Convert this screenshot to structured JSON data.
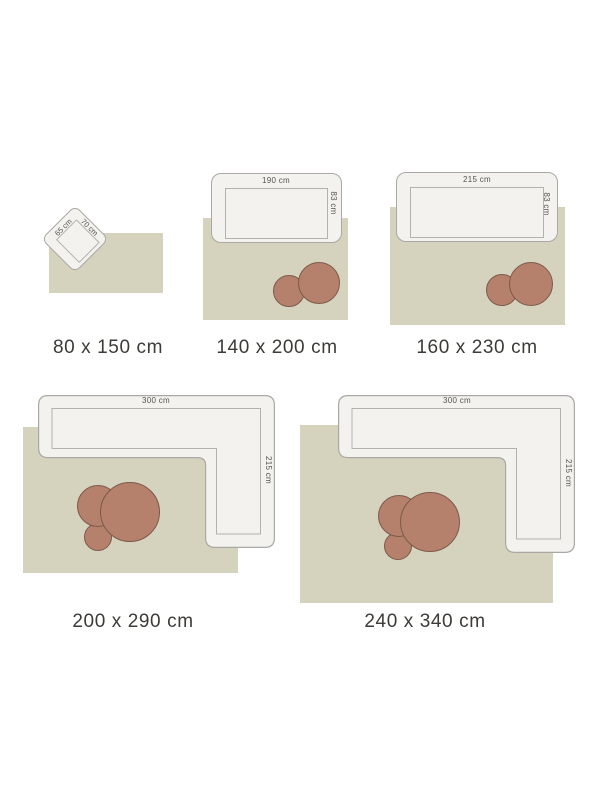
{
  "colors": {
    "background": "#ffffff",
    "rug": "#d5d2bd",
    "furniture_fill": "#f3f2ef",
    "furniture_outline": "#a9a8a2",
    "furniture_inner_line": "#b3b2ac",
    "pouf_fill": "#b5816c",
    "pouf_outline": "#7d594a",
    "size_label_text": "#3d3b37",
    "dimension_text": "#57544e"
  },
  "panels": [
    {
      "size_label": "80 x 150 cm",
      "furniture_type": "armchair",
      "furniture_width": "65 cm",
      "furniture_depth": "70 cm"
    },
    {
      "size_label": "140 x 200 cm",
      "furniture_type": "sofa",
      "furniture_width": "190 cm",
      "furniture_depth": "83 cm"
    },
    {
      "size_label": "160 x 230 cm",
      "furniture_type": "sofa",
      "furniture_width": "215 cm",
      "furniture_depth": "83 cm"
    },
    {
      "size_label": "200 x 290 cm",
      "furniture_type": "corner-sofa",
      "furniture_width": "300 cm",
      "furniture_depth": "215 cm"
    },
    {
      "size_label": "240 x 340 cm",
      "furniture_type": "corner-sofa",
      "furniture_width": "300 cm",
      "furniture_depth": "215 cm"
    }
  ]
}
